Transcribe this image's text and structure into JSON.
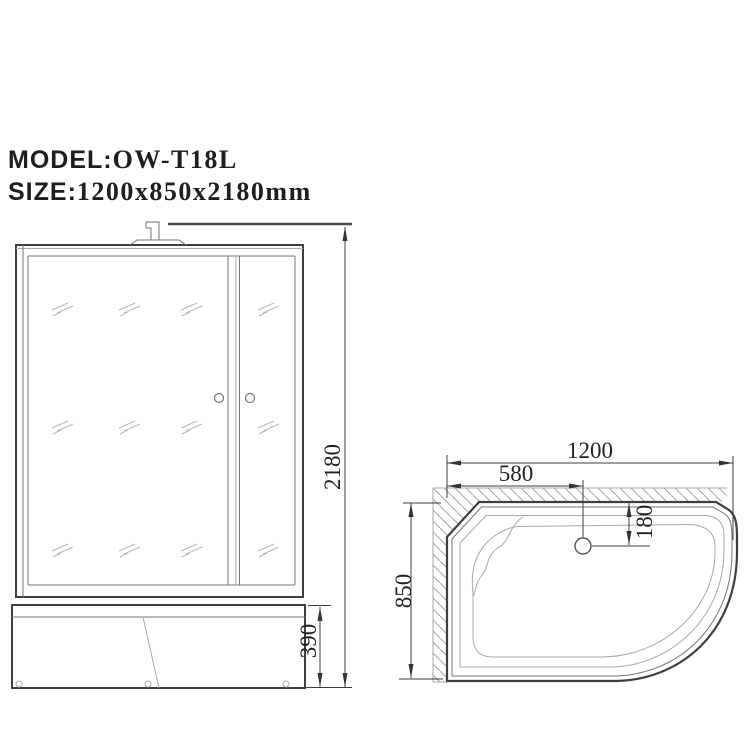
{
  "title_block": {
    "model_label": "MODEL:",
    "model_value": "OW-T18L",
    "size_label": "SIZE:",
    "size_value": "1200x850x2180mm"
  },
  "front_view": {
    "dims": {
      "total_height": "2180",
      "base_height": "390"
    }
  },
  "plan_view": {
    "dims": {
      "width": "1200",
      "drain_offset_x": "580",
      "drain_offset_y": "180",
      "depth": "850"
    }
  },
  "colors": {
    "line_dark": "#3f3f3f",
    "line_medium": "#757575",
    "line_light": "#a8a8a8",
    "hatch": "#a6a6a6",
    "text": "#222222",
    "background": "#ffffff"
  }
}
